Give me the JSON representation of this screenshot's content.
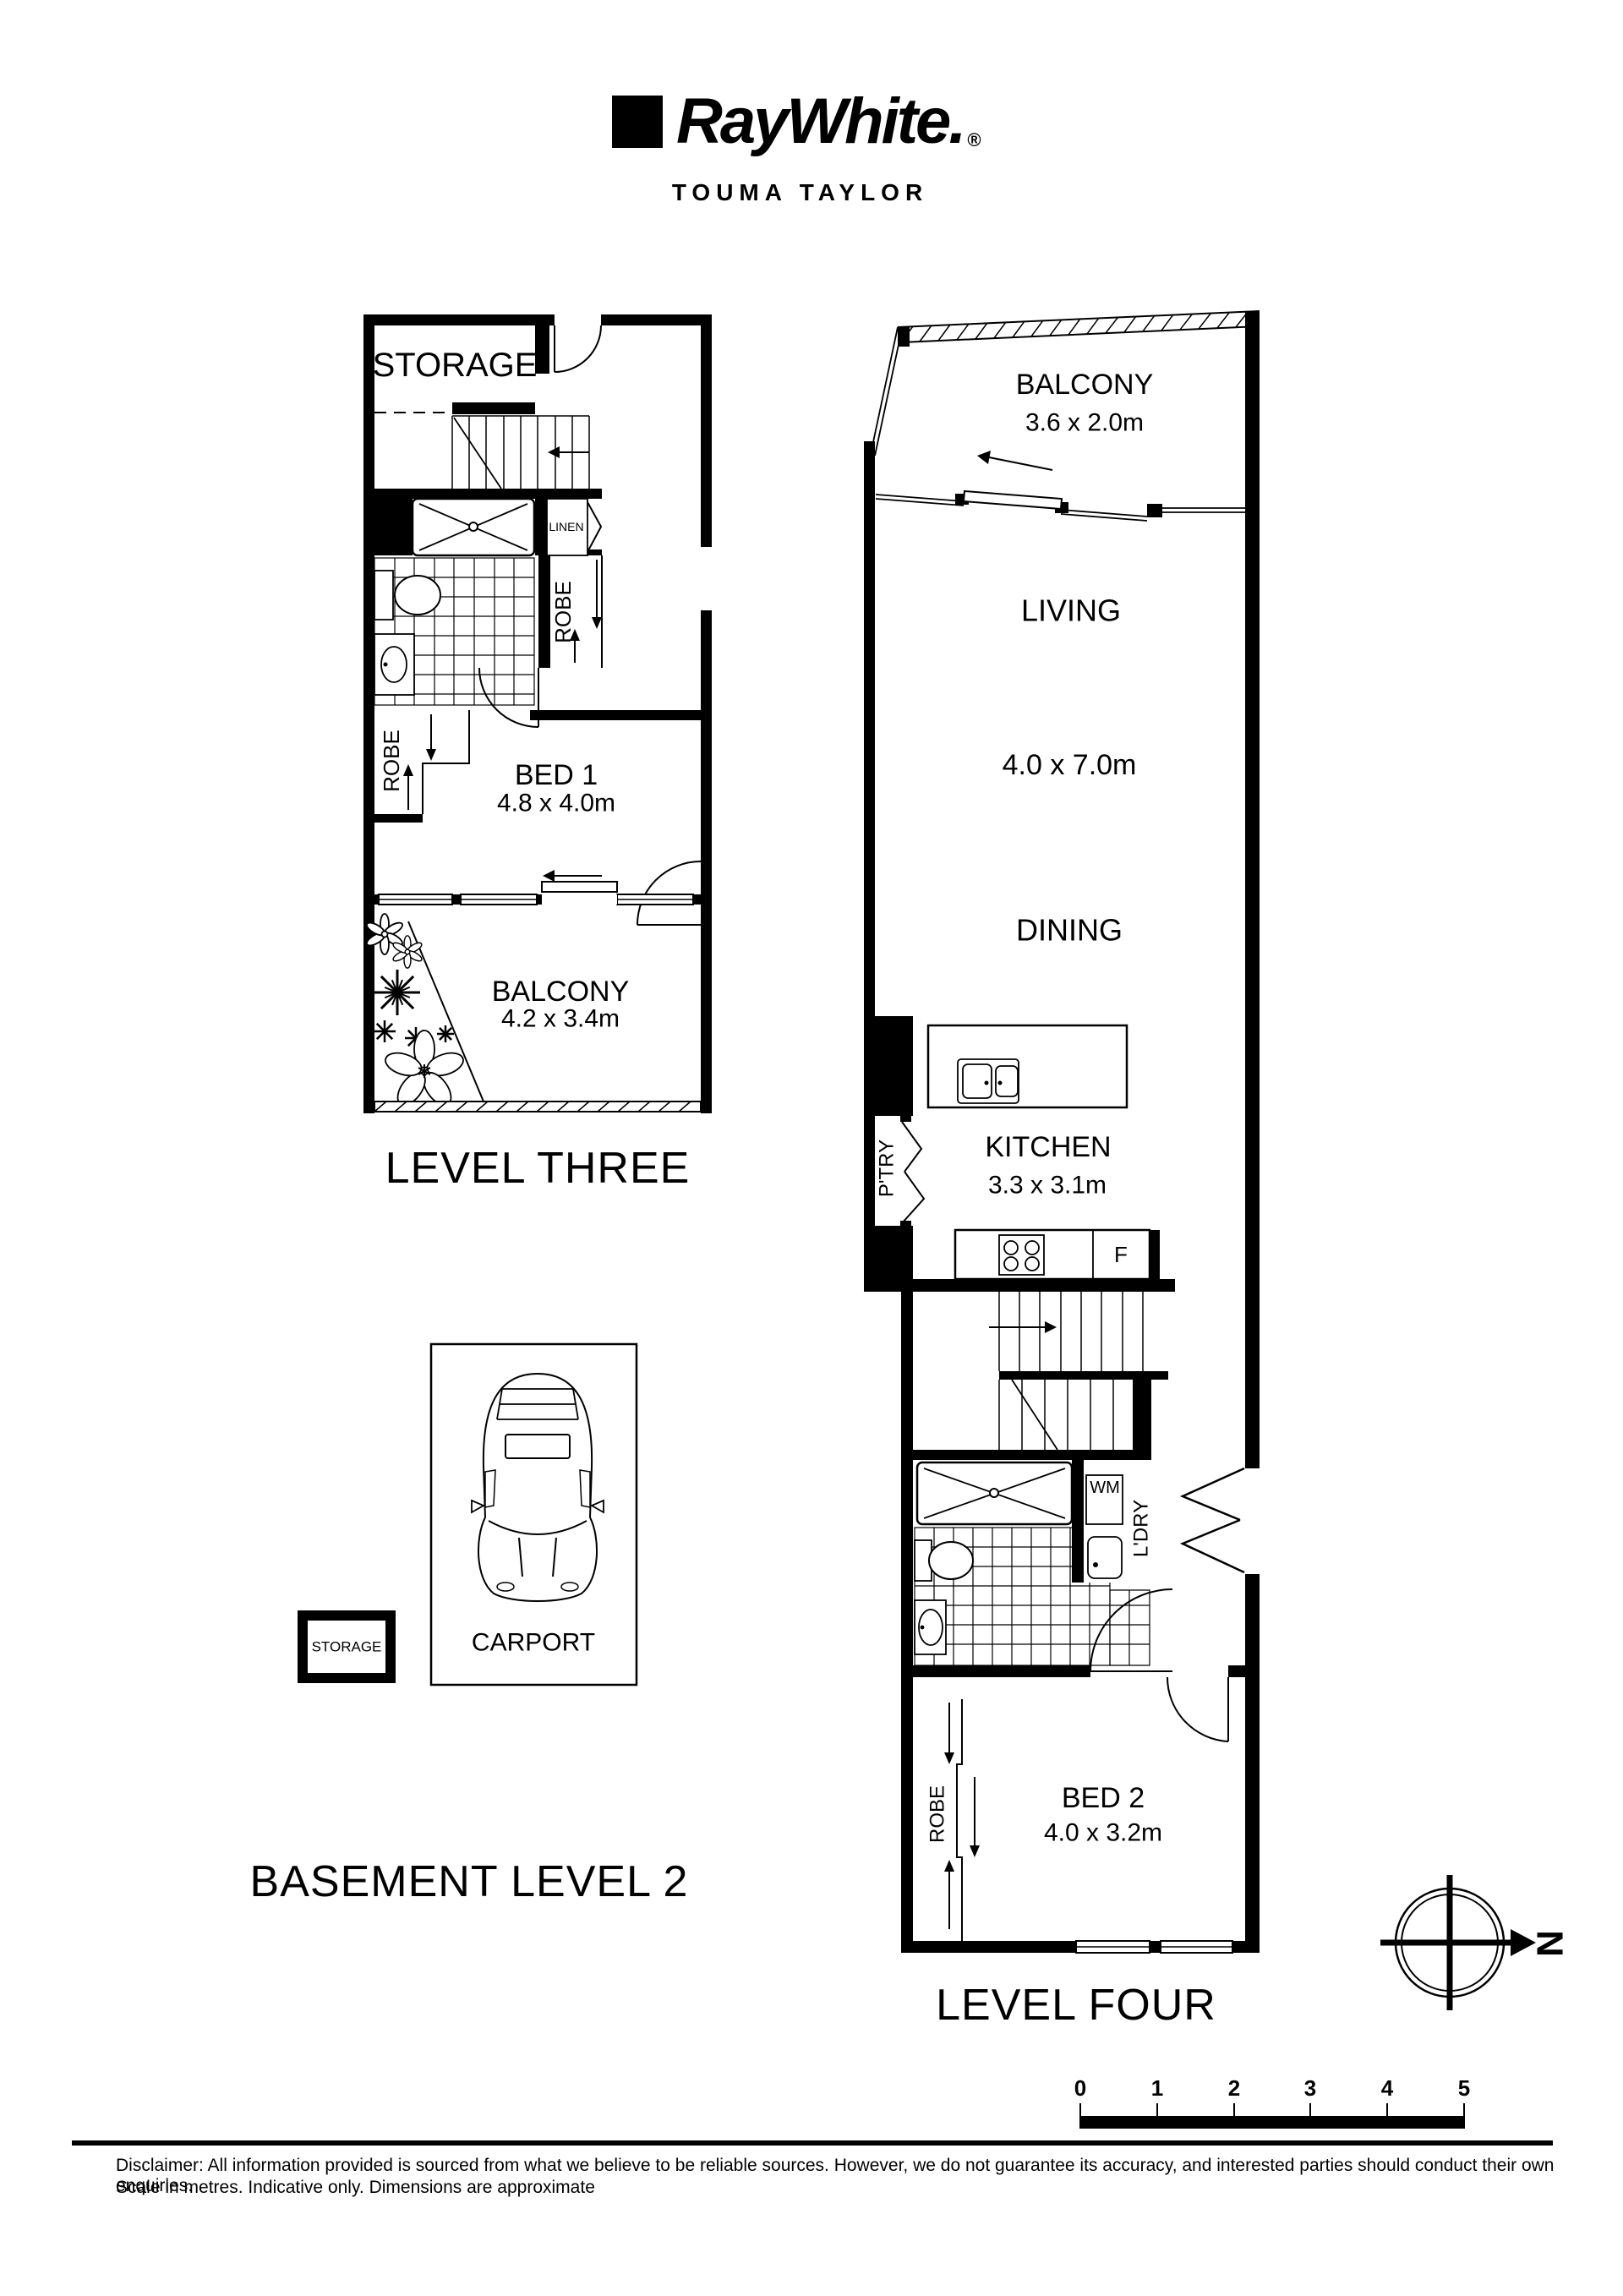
{
  "header": {
    "brand": "RayWhite.",
    "registered": "®",
    "office": "TOUMA TAYLOR"
  },
  "level_three": {
    "title": "LEVEL THREE",
    "storage": "STORAGE",
    "linen": "LINEN",
    "robe_hall": "ROBE",
    "robe_bed": "ROBE",
    "bed1_name": "BED 1",
    "bed1_dims": "4.8 x 4.0m",
    "balcony_name": "BALCONY",
    "balcony_dims": "4.2 x 3.4m"
  },
  "level_four": {
    "title": "LEVEL FOUR",
    "balcony_name": "BALCONY",
    "balcony_dims": "3.6 x 2.0m",
    "living": "LIVING",
    "living_dims": "4.0 x 7.0m",
    "dining": "DINING",
    "pantry": "P'TRY",
    "kitchen_name": "KITCHEN",
    "kitchen_dims": "3.3 x 3.1m",
    "fridge": "F",
    "washing_machine": "WM",
    "laundry": "L'DRY",
    "robe": "ROBE",
    "bed2_name": "BED 2",
    "bed2_dims": "4.0 x 3.2m"
  },
  "basement": {
    "title": "BASEMENT LEVEL 2",
    "carport": "CARPORT",
    "storage": "STORAGE"
  },
  "compass": {
    "north": "N"
  },
  "scale_bar": {
    "labels": [
      "0",
      "1",
      "2",
      "3",
      "4",
      "5"
    ]
  },
  "footer": {
    "disclaimer_line1": "Disclaimer: All information provided is sourced from what we believe to be reliable sources. However, we do not guarantee its accuracy, and interested parties should conduct their own enquiries.",
    "disclaimer_line2": "Scale in metres. Indicative only. Dimensions are approximate"
  }
}
